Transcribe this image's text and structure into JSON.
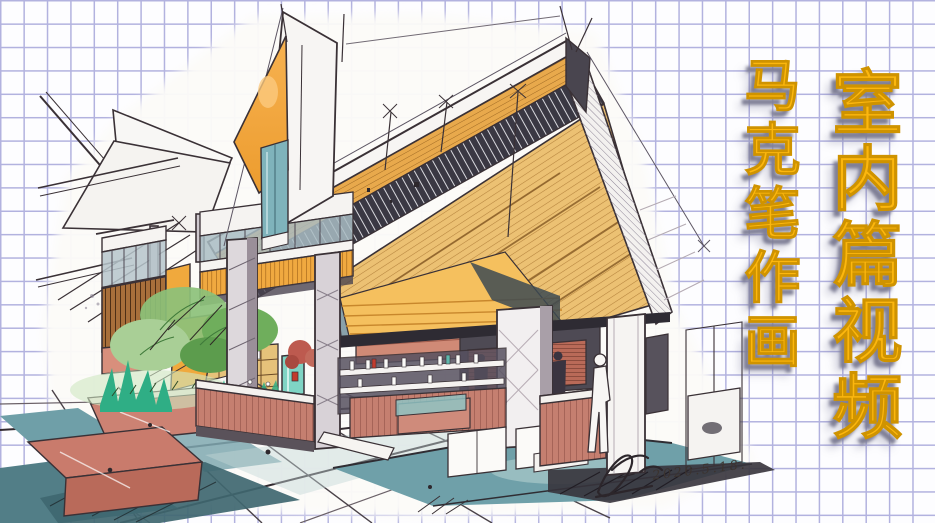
{
  "poster": {
    "main_title": {
      "text": "室内篇视频",
      "orientation": "vertical-right-column"
    },
    "sub_title": {
      "text": "马克笔作画",
      "orientation": "vertical-left-column"
    },
    "signature": {
      "date": "2020.5.18."
    },
    "colors": {
      "title_yellow": "#fcb70e",
      "title_stroke": "#cf9300",
      "title_shadow": "#7f7f96",
      "grid_line": "#b2b2df",
      "paper": "#fdfdff",
      "sketch_paper": "#fcfbf8",
      "ink": "#3a3136",
      "accent_orange": "#f2a93d",
      "wood": "#ecc173",
      "teal_glass": "#7fb3bb",
      "floor_teal": "#6fa0a9",
      "brick_red": "#c57f70",
      "plant_green": "#6fae5c",
      "emerald": "#2fae85",
      "mint_door": "#7fd4c4",
      "column_gray": "#c3bcc4"
    }
  }
}
